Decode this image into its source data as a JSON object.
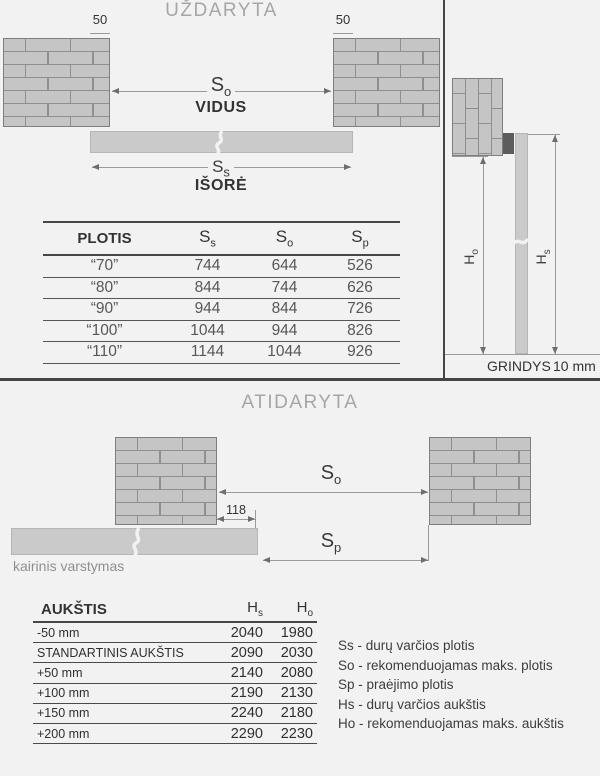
{
  "colors": {
    "bg": "#f2f2f2",
    "divider": "#454545",
    "brick": "#c5c5c5",
    "mortar": "#8f8f8f",
    "door": "#cacaca",
    "dimline": "#9a9a9a",
    "text": "#3a3a3a",
    "muted": "#a6a6a6"
  },
  "closed": {
    "title": "UŽDARYTA",
    "dim_50_left": "50",
    "dim_50_right": "50",
    "so": {
      "base": "S",
      "sub": "o"
    },
    "inside_label": "VIDUS",
    "ss": {
      "base": "S",
      "sub": "s"
    },
    "outside_label": "IŠORĖ"
  },
  "side_view": {
    "ho": {
      "base": "H",
      "sub": "o"
    },
    "hs": {
      "base": "H",
      "sub": "s"
    },
    "floor_label": "GRINDYS",
    "gap_label": "10 mm"
  },
  "width_table": {
    "headers": [
      "PLOTIS",
      "S|s",
      "S|o",
      "S|p"
    ],
    "rows": [
      [
        "“70”",
        "744",
        "644",
        "526"
      ],
      [
        "“80”",
        "844",
        "744",
        "626"
      ],
      [
        "“90”",
        "944",
        "844",
        "726"
      ],
      [
        "“100”",
        "1044",
        "944",
        "826"
      ],
      [
        "“110”",
        "1144",
        "1044",
        "926"
      ]
    ]
  },
  "open": {
    "title": "ATIDARYTA",
    "so": {
      "base": "S",
      "sub": "o"
    },
    "sp": {
      "base": "S",
      "sub": "p"
    },
    "dim_118": "118",
    "swing_label": "kairinis varstymas"
  },
  "height_table": {
    "headers": [
      "AUKŠTIS",
      "H|s",
      "H|o"
    ],
    "rows": [
      [
        "-50 mm",
        "2040",
        "1980"
      ],
      [
        "STANDARTINIS AUKŠTIS",
        "2090",
        "2030"
      ],
      [
        "+50 mm",
        "2140",
        "2080"
      ],
      [
        "+100 mm",
        "2190",
        "2130"
      ],
      [
        "+150 mm",
        "2240",
        "2180"
      ],
      [
        "+200 mm",
        "2290",
        "2230"
      ]
    ]
  },
  "legend": {
    "items": [
      "Ss - durų varčios plotis",
      "So - rekomenduojamas maks. plotis",
      "Sp - praėjimo plotis",
      "Hs - durų varčios aukštis",
      "Ho - rekomenduojamas maks. aukštis"
    ]
  }
}
